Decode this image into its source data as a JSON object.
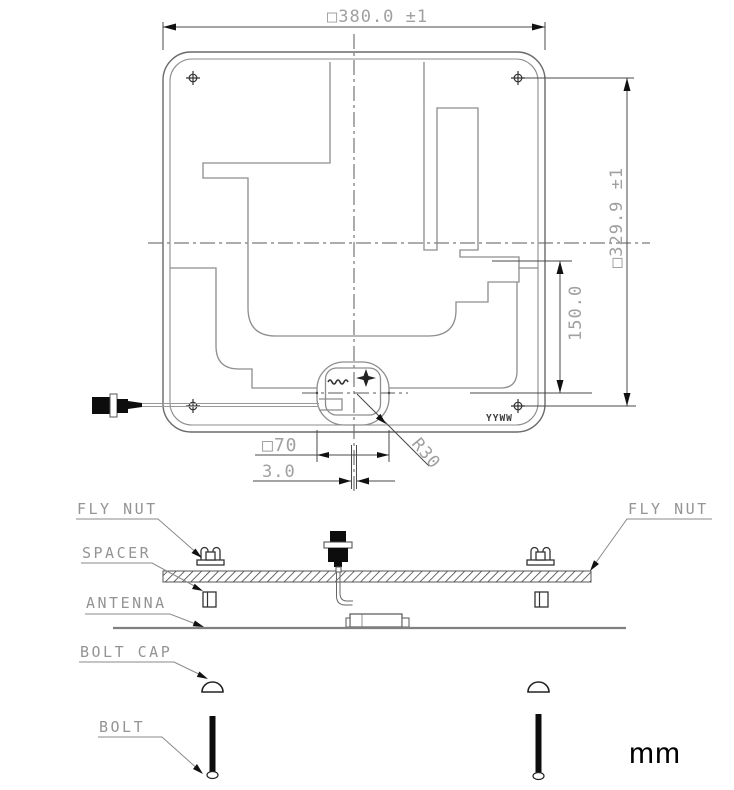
{
  "drawing": {
    "units_label": "mm",
    "top_view": {
      "dimensions": {
        "width": "□380.0  ±1",
        "height": "□329.9  ±1",
        "feed_offset": "150.0",
        "feed_square": "□70",
        "feed_gap": "3.0",
        "corner_radius": "R30"
      },
      "markings": {
        "date_code": "YYWW"
      }
    },
    "exploded_view": {
      "labels": {
        "fly_nut_left": "FLY NUT",
        "fly_nut_right": "FLY NUT",
        "spacer": "SPACER",
        "antenna": "ANTENNA",
        "bolt_cap": "BOLT CAP",
        "bolt": "BOLT"
      }
    },
    "colors": {
      "background": "#ffffff",
      "outline": "#6a6a6a",
      "trace": "#8d8d8d",
      "dim_text": "#a0a0a0",
      "label_text": "#949494",
      "hardware_black": "#0d0d0d"
    }
  }
}
